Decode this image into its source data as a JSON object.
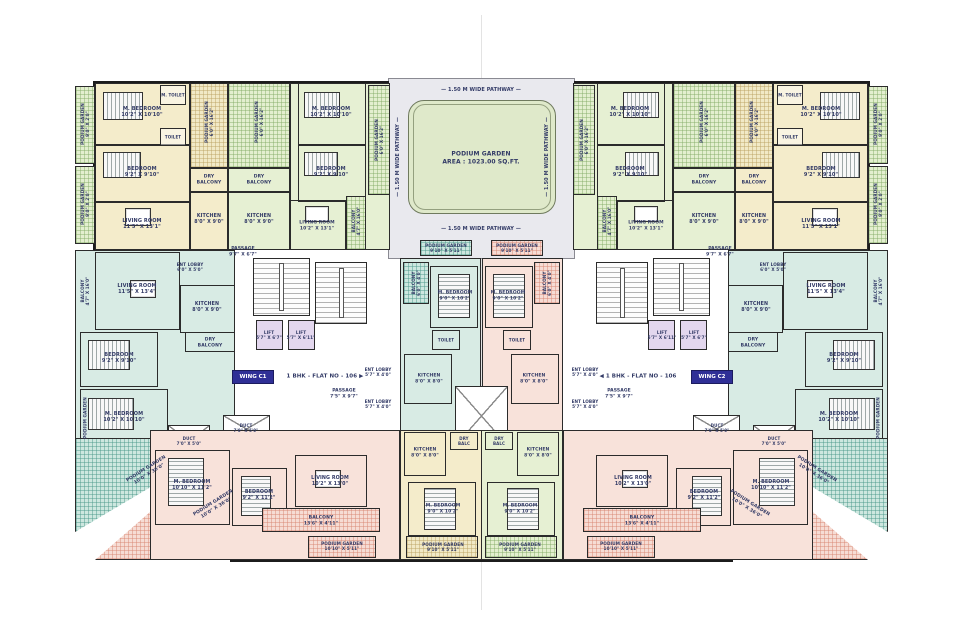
{
  "palette": {
    "wall": "#1c1c1c",
    "text": "#323a66",
    "badge_bg": "#2f2f96",
    "badge_text": "#ffffff",
    "courtyard": "#e9e9ee",
    "garden": "#dfe9ca",
    "unit_cream": "#f4eccb",
    "unit_green": "#e6f0d3",
    "unit_teal": "#d8ebe4",
    "unit_pink": "#f8e2da",
    "lift": "#e3d7ee"
  },
  "wings": {
    "c1": "WING C1",
    "c2": "WING C2"
  },
  "labels": [
    {
      "n": "pathway-top",
      "t": "—  1.50 M WIDE PATHWAY  —",
      "x": 481,
      "y": 90
    },
    {
      "n": "pathway-bottom",
      "t": "—  1.50 M WIDE PATHWAY  —",
      "x": 481,
      "y": 229
    },
    {
      "n": "pathway-left",
      "t": "—  1.50 M WIDE PATHWAY  —",
      "x": 398,
      "y": 157,
      "r": -90
    },
    {
      "n": "pathway-right",
      "t": "—  1.50 M WIDE PATHWAY  —",
      "x": 547,
      "y": 157,
      "r": -90
    },
    {
      "n": "podium-garden-main",
      "t": "PODIUM GARDEN\nAREA : 1023.00 SQ.FT.",
      "x": 481,
      "y": 158,
      "s": 6
    },
    {
      "n": "flat-c1",
      "t": "1 BHK - FLAT NO - 106  ▶",
      "x": 325,
      "y": 377,
      "s": 5.5,
      "w": 95
    },
    {
      "n": "flat-c2",
      "t": "◀  1 BHK - FLAT NO - 106",
      "x": 638,
      "y": 377,
      "s": 5.5,
      "w": 95
    },
    {
      "n": "passage-c1",
      "t": "PASSAGE\n7'5\" X 9'7\"",
      "x": 344,
      "y": 394,
      "s": 4.5
    },
    {
      "n": "passage-c2",
      "t": "PASSAGE\n7'5\" X 9'7\"",
      "x": 619,
      "y": 394,
      "s": 4.5
    },
    {
      "n": "passage-core-l",
      "t": "PASSAGE\n9'7\" X 6'7\"",
      "x": 243,
      "y": 252,
      "s": 4.5
    },
    {
      "n": "passage-core-r",
      "t": "PASSAGE\n9'7\" X 6'7\"",
      "x": 720,
      "y": 252,
      "s": 4.5
    },
    {
      "n": "yl-mbed",
      "t": "M. BEDROOM\n10'2\" X 10'10\"",
      "x": 142,
      "y": 112
    },
    {
      "n": "yl-bed",
      "t": "BEDROOM\n9'2\" X 9'10\"",
      "x": 142,
      "y": 172
    },
    {
      "n": "yl-living",
      "t": "LIVING ROOM\n11'5\" X 13'1\"",
      "x": 142,
      "y": 224
    },
    {
      "n": "yl-podium",
      "t": "PODIUM GARDEN\n6'0\" X 16'2\"",
      "x": 209,
      "y": 122,
      "r": -90,
      "s": 4.2
    },
    {
      "n": "yl-drybal",
      "t": "DRY\nBALCONY",
      "x": 209,
      "y": 180,
      "s": 4.5
    },
    {
      "n": "yl-kitchen",
      "t": "KITCHEN\n8'0\" X 9'0\"",
      "x": 209,
      "y": 220,
      "s": 4.8
    },
    {
      "n": "yl-strip1",
      "t": "PODIUM GARDEN\n9'0\" X 2'0\"",
      "x": 85,
      "y": 124,
      "r": -90,
      "s": 4.2
    },
    {
      "n": "yl-strip2",
      "t": "PODIUM GARDEN\n9'0\" X 2'0\"",
      "x": 85,
      "y": 204,
      "r": -90,
      "s": 4.2
    },
    {
      "n": "yl-mtoilet",
      "t": "M. TOILET",
      "x": 173,
      "y": 95,
      "s": 4
    },
    {
      "n": "yl-toilet",
      "t": "TOILET",
      "x": 173,
      "y": 137,
      "s": 4
    },
    {
      "n": "yr-mbed",
      "t": "M. BEDROOM\n10'2\" X 10'10\"",
      "x": 821,
      "y": 112
    },
    {
      "n": "yr-bed",
      "t": "BEDROOM\n9'2\" X 9'10\"",
      "x": 821,
      "y": 172
    },
    {
      "n": "yr-living",
      "t": "LIVING ROOM\n11'5\" X 13'1\"",
      "x": 821,
      "y": 224
    },
    {
      "n": "yr-podium",
      "t": "PODIUM GARDEN\n6'0\" X 16'2\"",
      "x": 754,
      "y": 122,
      "r": -90,
      "s": 4.2
    },
    {
      "n": "yr-drybal",
      "t": "DRY\nBALCONY",
      "x": 754,
      "y": 180,
      "s": 4.5
    },
    {
      "n": "yr-kitchen",
      "t": "KITCHEN\n8'0\" X 9'0\"",
      "x": 754,
      "y": 220,
      "s": 4.8
    },
    {
      "n": "yr-strip1",
      "t": "PODIUM GARDEN\n9'0\" X 2'0\"",
      "x": 878,
      "y": 124,
      "r": -90,
      "s": 4.2
    },
    {
      "n": "yr-strip2",
      "t": "PODIUM GARDEN\n9'0\" X 2'0\"",
      "x": 878,
      "y": 204,
      "r": -90,
      "s": 4.2
    },
    {
      "n": "yr-mtoilet",
      "t": "M. TOILET",
      "x": 790,
      "y": 95,
      "s": 4
    },
    {
      "n": "yr-toilet",
      "t": "TOILET",
      "x": 790,
      "y": 137,
      "s": 4
    },
    {
      "n": "gl-podium",
      "t": "PODIUM GARDEN\n6'0\" X 16'2\"",
      "x": 259,
      "y": 122,
      "r": -90,
      "s": 4.2
    },
    {
      "n": "gl-drybal",
      "t": "DRY\nBALCONY",
      "x": 259,
      "y": 180,
      "s": 4.5
    },
    {
      "n": "gl-kitchen",
      "t": "KITCHEN\n8'0\" X 9'0\"",
      "x": 259,
      "y": 220,
      "s": 4.8
    },
    {
      "n": "gl-mbed",
      "t": "M. BEDROOM\n10'2\" X 10'10\"",
      "x": 331,
      "y": 112
    },
    {
      "n": "gl-bed",
      "t": "BEDROOM\n9'2\" X 9'10\"",
      "x": 331,
      "y": 172
    },
    {
      "n": "gl-living",
      "t": "LIVING ROOM\n10'2\" X 13'1\"",
      "x": 317,
      "y": 226,
      "s": 4.5
    },
    {
      "n": "gl-balcony",
      "t": "BALCONY\n4'7\" X 16'0\"",
      "x": 356,
      "y": 221,
      "r": -90,
      "s": 4.2
    },
    {
      "n": "gl-podium2",
      "t": "PODIUM GARDEN\n6'0\" X 16'2\"",
      "x": 379,
      "y": 140,
      "r": -90,
      "s": 4.2
    },
    {
      "n": "gr-podium",
      "t": "PODIUM GARDEN\n6'0\" X 16'2\"",
      "x": 704,
      "y": 122,
      "r": -90,
      "s": 4.2
    },
    {
      "n": "gr-drybal",
      "t": "DRY\nBALCONY",
      "x": 704,
      "y": 180,
      "s": 4.5
    },
    {
      "n": "gr-kitchen",
      "t": "KITCHEN\n8'0\" X 9'0\"",
      "x": 704,
      "y": 220,
      "s": 4.8
    },
    {
      "n": "gr-mbed",
      "t": "M. BEDROOM\n10'2\" X 10'10\"",
      "x": 630,
      "y": 112
    },
    {
      "n": "gr-bed",
      "t": "BEDROOM\n9'2\" X 9'10\"",
      "x": 630,
      "y": 172
    },
    {
      "n": "gr-living",
      "t": "LIVING ROOM\n10'2\" X 13'1\"",
      "x": 646,
      "y": 226,
      "s": 4.5
    },
    {
      "n": "gr-balcony",
      "t": "BALCONY\n4'7\" X 16'0\"",
      "x": 607,
      "y": 221,
      "r": -90,
      "s": 4.2
    },
    {
      "n": "gr-podium2",
      "t": "PODIUM GARDEN\n6'0\" X 16'2\"",
      "x": 584,
      "y": 140,
      "r": -90,
      "s": 4.2
    },
    {
      "n": "strip-under-court-l",
      "t": "PODIUM GARDEN\n9'10\" X 5'11\"",
      "x": 446,
      "y": 248,
      "s": 4.2
    },
    {
      "n": "strip-under-court-r",
      "t": "PODIUM GARDEN\n9'10\" X 5'11\"",
      "x": 517,
      "y": 248,
      "s": 4.2
    },
    {
      "n": "tl-living",
      "t": "LIVING ROOM\n11'5\" X 13'4\"",
      "x": 137,
      "y": 289
    },
    {
      "n": "tl-kitchen",
      "t": "KITCHEN\n8'0\" X 9'0\"",
      "x": 207,
      "y": 308,
      "s": 4.8
    },
    {
      "n": "tl-bed",
      "t": "BEDROOM\n9'2\" X 9'10\"",
      "x": 119,
      "y": 358
    },
    {
      "n": "tl-mbed",
      "t": "M. BEDROOM\n10'2\" X 10'10\"",
      "x": 124,
      "y": 417
    },
    {
      "n": "tl-drybal",
      "t": "DRY\nBALCONY",
      "x": 210,
      "y": 343,
      "s": 4.5
    },
    {
      "n": "tl-balcony",
      "t": "BALCONY\n4'7\" X 16'0\"",
      "x": 85,
      "y": 291,
      "r": -90,
      "s": 4.2
    },
    {
      "n": "tl-podium",
      "t": "PODIUM GARDEN",
      "x": 85,
      "y": 418,
      "r": -90,
      "s": 4.2
    },
    {
      "n": "tl-entlobby",
      "t": "ENT LOBBY\n6'0\" X 5'0\"",
      "x": 190,
      "y": 267,
      "s": 4.2
    },
    {
      "n": "tr-living",
      "t": "LIVING ROOM\n11'5\" X 13'4\"",
      "x": 826,
      "y": 289
    },
    {
      "n": "tr-kitchen",
      "t": "KITCHEN\n8'0\" X 9'0\"",
      "x": 756,
      "y": 308,
      "s": 4.8
    },
    {
      "n": "tr-bed",
      "t": "BEDROOM\n9'2\" X 9'10\"",
      "x": 844,
      "y": 358
    },
    {
      "n": "tr-mbed",
      "t": "M. BEDROOM\n10'2\" X 10'10\"",
      "x": 839,
      "y": 417
    },
    {
      "n": "tr-drybal",
      "t": "DRY\nBALCONY",
      "x": 753,
      "y": 343,
      "s": 4.5
    },
    {
      "n": "tr-balcony",
      "t": "BALCONY\n4'7\" X 16'0\"",
      "x": 878,
      "y": 291,
      "r": -90,
      "s": 4.2
    },
    {
      "n": "tr-podium",
      "t": "PODIUM GARDEN",
      "x": 878,
      "y": 418,
      "r": -90,
      "s": 4.2
    },
    {
      "n": "tr-entlobby",
      "t": "ENT LOBBY\n6'0\" X 5'0\"",
      "x": 773,
      "y": 267,
      "s": 4.2
    },
    {
      "n": "lift-l1",
      "t": "LIFT\n5'7\" X 6'7\"",
      "x": 269,
      "y": 335,
      "s": 4.2
    },
    {
      "n": "lift-l2",
      "t": "LIFT\n5'7\" X 6'11\"",
      "x": 301,
      "y": 335,
      "s": 4.2
    },
    {
      "n": "lift-r1",
      "t": "LIFT\n5'7\" X 6'7\"",
      "x": 694,
      "y": 335,
      "s": 4.2
    },
    {
      "n": "lift-r2",
      "t": "LIFT\n5'7\" X 6'11\"",
      "x": 662,
      "y": 335,
      "s": 4.2
    },
    {
      "n": "entlobby-l2",
      "t": "ENT LOBBY\n5'7\" X 4'0\"",
      "x": 378,
      "y": 372,
      "s": 4.2
    },
    {
      "n": "entlobby-l3",
      "t": "ENT LOBBY\n5'7\" X 4'0\"",
      "x": 378,
      "y": 404,
      "s": 4.2
    },
    {
      "n": "entlobby-r2",
      "t": "ENT LOBBY\n5'7\" X 4'0\"",
      "x": 585,
      "y": 372,
      "s": 4.2
    },
    {
      "n": "entlobby-r3",
      "t": "ENT LOBBY\n5'7\" X 4'0\"",
      "x": 585,
      "y": 404,
      "s": 4.2
    },
    {
      "n": "cl-balcony",
      "t": "BALCONY\n6'0\" X 4'0\"",
      "x": 416,
      "y": 283,
      "r": -90,
      "s": 4.2
    },
    {
      "n": "cl-mbed",
      "t": "M. BEDROOM\n9'0\" X 10'2\"",
      "x": 455,
      "y": 296,
      "s": 4.5
    },
    {
      "n": "cl-toilet",
      "t": "TOILET",
      "x": 446,
      "y": 340,
      "s": 4
    },
    {
      "n": "cl-kitchen",
      "t": "KITCHEN\n8'0\" X 8'0\"",
      "x": 429,
      "y": 379,
      "s": 4.5
    },
    {
      "n": "cr-balcony",
      "t": "BALCONY\n6'0\" X 4'0\"",
      "x": 547,
      "y": 283,
      "r": -90,
      "s": 4.2
    },
    {
      "n": "cr-mbed",
      "t": "M. BEDROOM\n9'0\" X 10'2\"",
      "x": 508,
      "y": 296,
      "s": 4.5
    },
    {
      "n": "cr-toilet",
      "t": "TOILET",
      "x": 517,
      "y": 340,
      "s": 4
    },
    {
      "n": "cr-kitchen",
      "t": "KITCHEN\n8'0\" X 8'0\"",
      "x": 534,
      "y": 379,
      "s": 4.5
    },
    {
      "n": "duct-l1",
      "t": "DUCT\n7'0\" X 5'0\"",
      "x": 189,
      "y": 441,
      "s": 4
    },
    {
      "n": "duct-l2",
      "t": "DUCT\n7'0\" X 5'0\"",
      "x": 246,
      "y": 428,
      "s": 4
    },
    {
      "n": "duct-r1",
      "t": "DUCT\n7'0\" X 5'0\"",
      "x": 774,
      "y": 441,
      "s": 4
    },
    {
      "n": "duct-r2",
      "t": "DUCT\n7'0\" X 5'0\"",
      "x": 717,
      "y": 428,
      "s": 4
    },
    {
      "n": "tri-teal-l",
      "t": "PODIUM GARDEN\n10'0\" X 36'0\"",
      "x": 148,
      "y": 472,
      "r": -32,
      "s": 4.6
    },
    {
      "n": "tri-pink-l",
      "t": "PODIUM GARDEN\n10'0\" X 36'0\"",
      "x": 215,
      "y": 506,
      "r": -32,
      "s": 4.6
    },
    {
      "n": "tri-teal-r",
      "t": "PODIUM GARDEN\n10'0\" X 36'0\"",
      "x": 815,
      "y": 472,
      "r": 32,
      "s": 4.6
    },
    {
      "n": "tri-pink-r",
      "t": "PODIUM GARDEN\n10'0\" X 36'0\"",
      "x": 748,
      "y": 506,
      "r": 32,
      "s": 4.6
    },
    {
      "n": "bl-mbed",
      "t": "M. BEDROOM\n10'10\" X 11'2\"",
      "x": 192,
      "y": 486,
      "s": 4.8
    },
    {
      "n": "bl-bed",
      "t": "BEDROOM\n9'2\" X 11'2\"",
      "x": 259,
      "y": 496,
      "s": 4.8
    },
    {
      "n": "bl-living",
      "t": "LIVING ROOM\n10'2\" X 13'0\"",
      "x": 330,
      "y": 482,
      "s": 4.8
    },
    {
      "n": "bl-balcony",
      "t": "BALCONY\n13'6\" X 4'11\"",
      "x": 321,
      "y": 521,
      "s": 4.5
    },
    {
      "n": "br-mbed",
      "t": "M. BEDROOM\n10'10\" X 11'2\"",
      "x": 771,
      "y": 486,
      "s": 4.8
    },
    {
      "n": "br-bed",
      "t": "BEDROOM\n9'2\" X 11'2\"",
      "x": 704,
      "y": 496,
      "s": 4.8
    },
    {
      "n": "br-living",
      "t": "LIVING ROOM\n10'2\" X 13'0\"",
      "x": 633,
      "y": 482,
      "s": 4.8
    },
    {
      "n": "br-balcony",
      "t": "BALCONY\n13'6\" X 4'11\"",
      "x": 642,
      "y": 521,
      "s": 4.5
    },
    {
      "n": "cbl-kitchen",
      "t": "KITCHEN\n8'0\" X 8'0\"",
      "x": 425,
      "y": 453,
      "s": 4.5
    },
    {
      "n": "cbl-drybalc",
      "t": "DRY\nBALC",
      "x": 464,
      "y": 441,
      "s": 4
    },
    {
      "n": "cbl-mbed",
      "t": "M. BEDROOM\n9'0\" X 10'2\"",
      "x": 443,
      "y": 509,
      "s": 4.5
    },
    {
      "n": "cbl-podium",
      "t": "PODIUM GARDEN\n9'10\" X 5'11\"",
      "x": 443,
      "y": 547,
      "s": 4.2
    },
    {
      "n": "cbr-kitchen",
      "t": "KITCHEN\n8'0\" X 8'0\"",
      "x": 538,
      "y": 453,
      "s": 4.5
    },
    {
      "n": "cbr-drybalc",
      "t": "DRY\nBALC",
      "x": 499,
      "y": 441,
      "s": 4
    },
    {
      "n": "cbr-mbed",
      "t": "M. BEDROOM\n9'0\" X 10'2\"",
      "x": 520,
      "y": 509,
      "s": 4.5
    },
    {
      "n": "cbr-podium",
      "t": "PODIUM GARDEN\n9'10\" X 5'11\"",
      "x": 520,
      "y": 547,
      "s": 4.2
    },
    {
      "n": "pink-strip-l",
      "t": "PODIUM GARDEN\n10'10\" X 5'11\"",
      "x": 342,
      "y": 546,
      "s": 4.2
    },
    {
      "n": "pink-strip-r",
      "t": "PODIUM GARDEN\n10'10\" X 5'11\"",
      "x": 621,
      "y": 546,
      "s": 4.2
    }
  ]
}
